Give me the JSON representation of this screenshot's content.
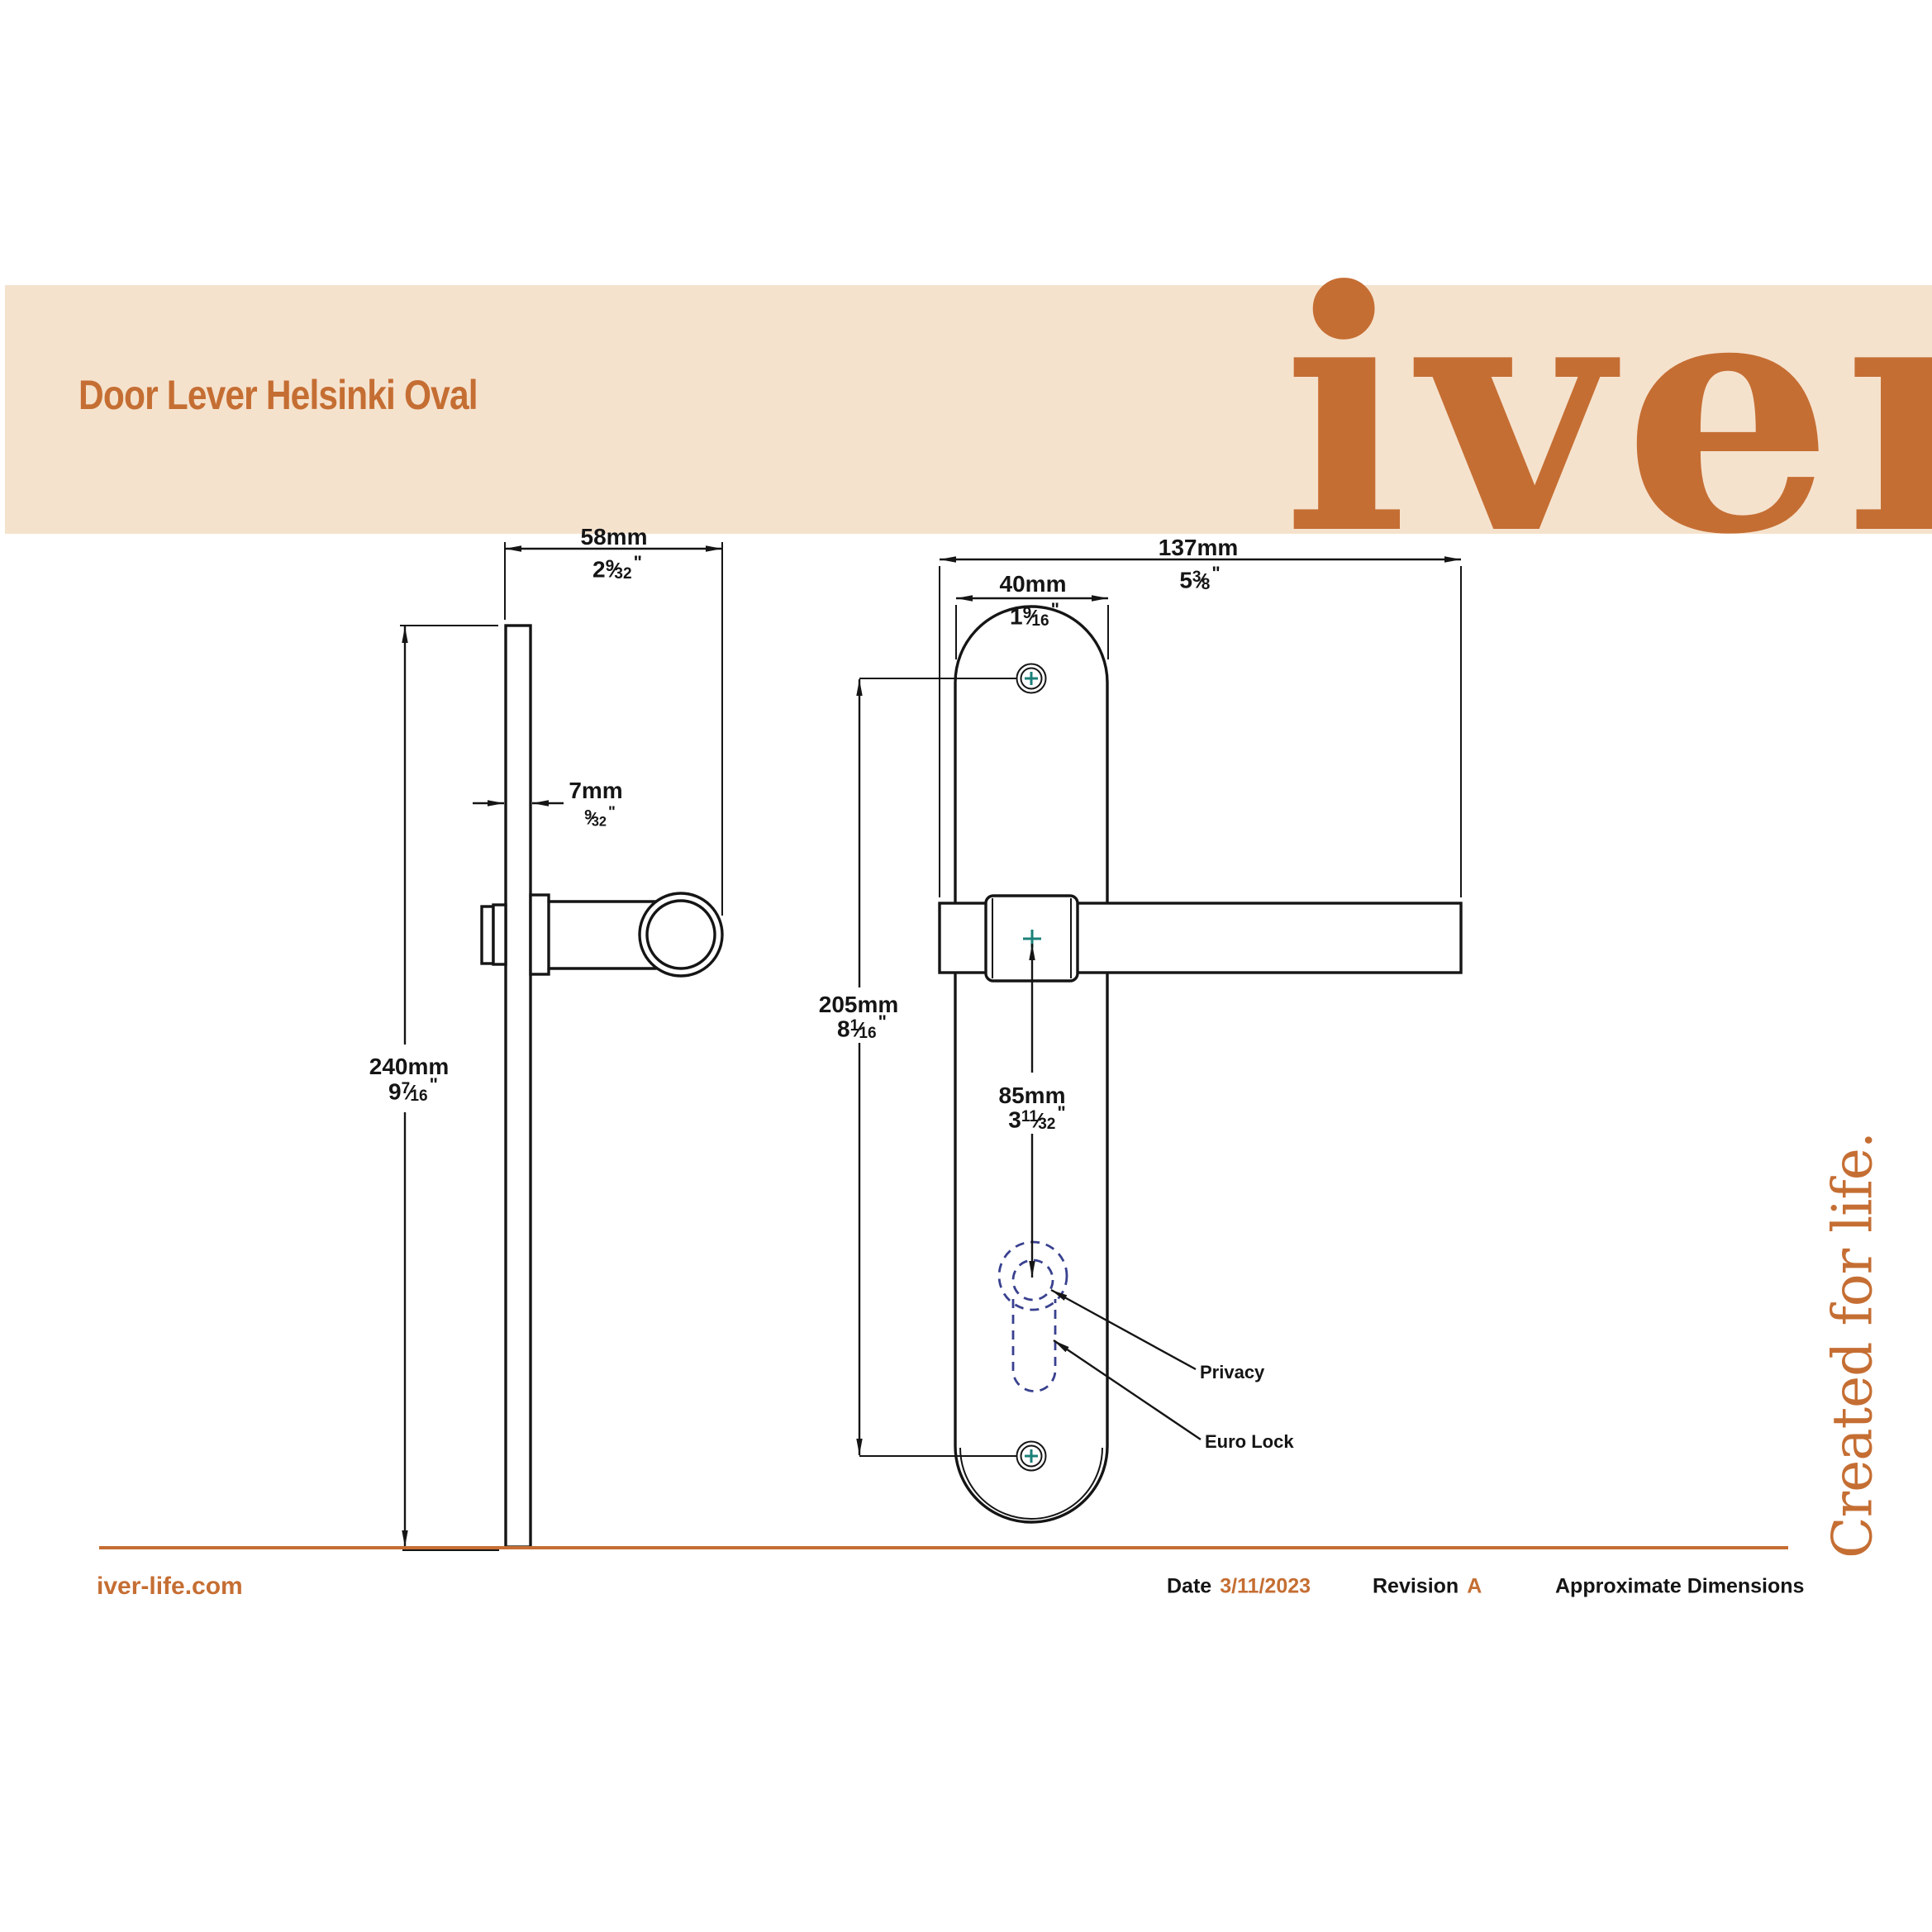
{
  "header": {
    "title": "Door Lever Helsinki Oval",
    "logo": "iver"
  },
  "tagline": "Created for life.",
  "symbols": {
    "frac": "⁄",
    "inch": "\""
  },
  "dimensions": {
    "depth": {
      "metric": "58mm",
      "inch_whole": "2",
      "inch_num": "9",
      "inch_den": "32"
    },
    "thickness": {
      "metric": "7mm",
      "inch_whole": "",
      "inch_num": "9",
      "inch_den": "32"
    },
    "plate_height": {
      "metric": "240mm",
      "inch_whole": "9",
      "inch_num": "7",
      "inch_den": "16"
    },
    "lever_length": {
      "metric": "137mm",
      "inch_whole": "5",
      "inch_num": "3",
      "inch_den": "8"
    },
    "plate_width": {
      "metric": "40mm",
      "inch_whole": "1",
      "inch_num": "9",
      "inch_den": "16"
    },
    "screw_centers": {
      "metric": "205mm",
      "inch_whole": "8",
      "inch_num": "1",
      "inch_den": "16"
    },
    "hub_to_keyhole": {
      "metric": "85mm",
      "inch_whole": "3",
      "inch_num": "11",
      "inch_den": "32"
    }
  },
  "annotations": {
    "privacy": "Privacy",
    "euro_lock": "Euro Lock"
  },
  "footer": {
    "website": "iver-life.com",
    "date_label": "Date",
    "date_value": "3/11/2023",
    "revision_label": "Revision",
    "revision_value": "A",
    "note": "Approximate Dimensions"
  },
  "colors": {
    "accent": "#C56E33",
    "band": "#F5E2CD",
    "ink": "#151515",
    "teal": "#1B807A",
    "navy": "#39418F",
    "paper": "#FFFFFF"
  }
}
